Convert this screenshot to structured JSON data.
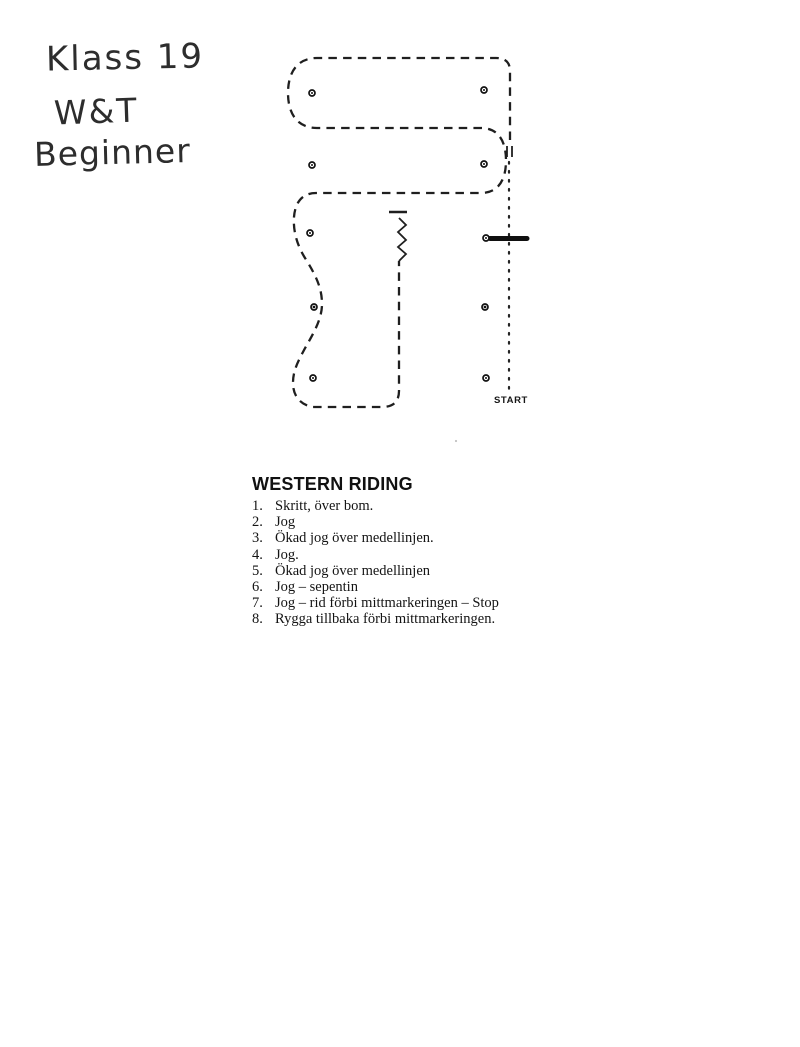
{
  "colors": {
    "ink": "#1f1f1f",
    "paper": "#ffffff"
  },
  "handwriting": {
    "line1": "Klass 19",
    "line2": "W&T",
    "line3": "Beginner"
  },
  "diagram": {
    "start_label": "START",
    "gaits": {
      "dashed_line_meaning": "jog",
      "dotted_line_meaning": "skritt (walk)",
      "zigzag_meaning": "rygga (back up)",
      "thick_bar_meaning": "bom (pole)"
    }
  },
  "instructions": {
    "title": "WESTERN RIDING",
    "items": [
      {
        "num": "1.",
        "text": "Skritt, över bom."
      },
      {
        "num": "2.",
        "text": "Jog"
      },
      {
        "num": "3.",
        "text": "Ökad jog över medellinjen."
      },
      {
        "num": "4.",
        "text": "Jog."
      },
      {
        "num": "5.",
        "text": "Ökad jog över medellinjen"
      },
      {
        "num": "6.",
        "text": "Jog – sepentin"
      },
      {
        "num": "7.",
        "text": "Jog – rid förbi mittmarkeringen – Stop"
      },
      {
        "num": "8.",
        "text": "Rygga tillbaka förbi mittmarkeringen."
      }
    ]
  }
}
